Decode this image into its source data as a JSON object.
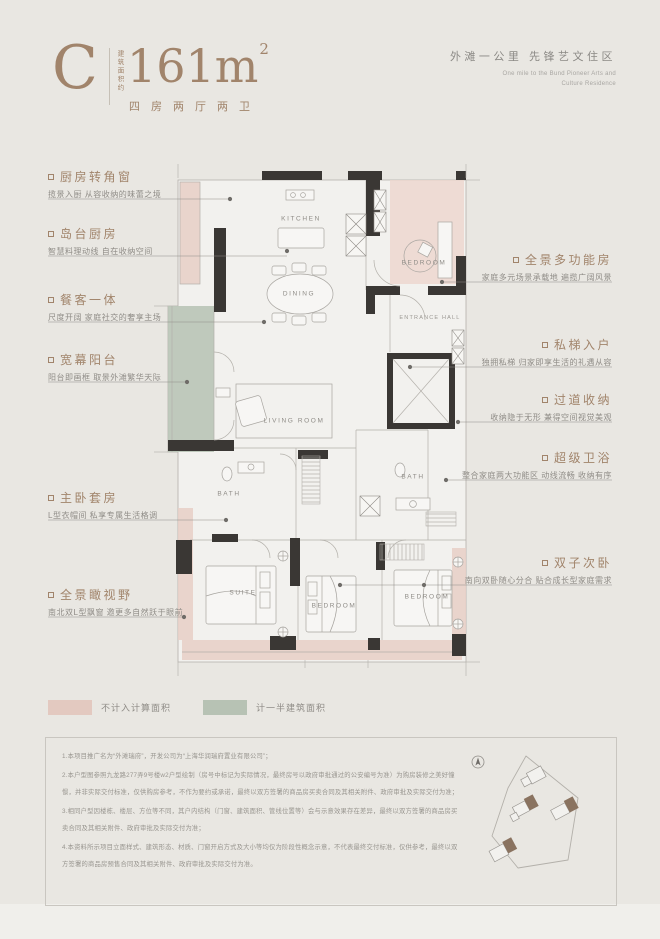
{
  "page": {
    "background": "#e9e7e2"
  },
  "header": {
    "unit_letter": "C",
    "area_prefix_vertical": "建筑面积约",
    "area_value": "161m",
    "area_sup": "2",
    "unit_layout": "四房两厅两卫",
    "tagline_cn": "外滩一公里  先锋艺文住区",
    "tagline_en_1": "One mile to the Bund Pioneer Arts and",
    "tagline_en_2": "Culture Residence"
  },
  "annotations": {
    "left": [
      {
        "title": "厨房转角窗",
        "desc": "揽景入厨 从容收纳的味蕾之境"
      },
      {
        "title": "岛台厨房",
        "desc": "智慧料理动线 自在收纳空间"
      },
      {
        "title": "餐客一体",
        "desc": "尺度开阔 家庭社交的奢享主场"
      },
      {
        "title": "宽幕阳台",
        "desc": "阳台即画框 取景外滩繁华天际"
      },
      {
        "title": "主卧套房",
        "desc": "L型衣帽间 私享专属生活格调"
      },
      {
        "title": "全景瞰视野",
        "desc": "南北双L型飘窗 邀更多自然跃于眼前"
      }
    ],
    "right": [
      {
        "title": "全景多功能房",
        "desc": "家庭多元场景承载地 遍揽广阔风景"
      },
      {
        "title": "私梯入户",
        "desc": "独拥私梯 归家即享生活的礼遇从容"
      },
      {
        "title": "过道收纳",
        "desc": "收纳隐于无形 兼得空间视觉美观"
      },
      {
        "title": "超级卫浴",
        "desc": "整合家庭两大功能区 动线流畅 收纳有序"
      },
      {
        "title": "双子次卧",
        "desc": "南向双卧随心分合 贴合成长型家庭需求"
      }
    ]
  },
  "plan": {
    "rooms": [
      {
        "label": "KITCHEN"
      },
      {
        "label": "DINING"
      },
      {
        "label": "BEDROOM"
      },
      {
        "label": "ENTRANCE HALL"
      },
      {
        "label": "LIVING ROOM"
      },
      {
        "label": "BATH"
      },
      {
        "label": "BATH"
      },
      {
        "label": "SUITE"
      },
      {
        "label": "BEDROOM"
      },
      {
        "label": "BEDROOM"
      }
    ],
    "colors": {
      "excluded_area": "#e3c9c0",
      "half_area": "#b7c2b4",
      "wall": "#3a3734",
      "thin_line": "#b3b0aa",
      "paper": "#f2f1ee"
    }
  },
  "legend": {
    "items": [
      {
        "label": "不计入计算面积",
        "color": "#e3c9c0"
      },
      {
        "label": "计一半建筑面积",
        "color": "#b7c2b4"
      }
    ]
  },
  "disclaimer": {
    "paragraphs": [
      "1.本项目推广名为“外滩瑞府”，开发公司为“上海华润瑞府置业有限公司”；",
      "2.本户型图参照九龙路277弄9号楼w2户型绘制（房号中标记为实际情况，最终房号以政府审批通过的公安编号为准）为购房装修之美好憧憬，并非实际交付标准，仅供购房参考，不作为要约或承诺，最终以双方签署的商品房买卖合同及其相关附件、政府审批及实际交付为准；",
      "3.相同户型因楼栋、楼层、方位等不同，其户内结构（门窗、建筑面积、管线位置等）会与示意效果存在差异，最终以双方签署的商品房买卖合同及其相关附件、政府审批及实际交付为准；",
      "4.本资料所示项目立面样式、建筑形态、材质、门窗开启方式及大小等均仅为阶段性概念示意，不代表最终交付标准，仅供参考，最终以双方签署的商品房预售合同及其相关附件、政府审批及实际交付为准。"
    ]
  },
  "colors": {
    "accent": "#a1846b",
    "text_gray": "#8f8c87"
  }
}
